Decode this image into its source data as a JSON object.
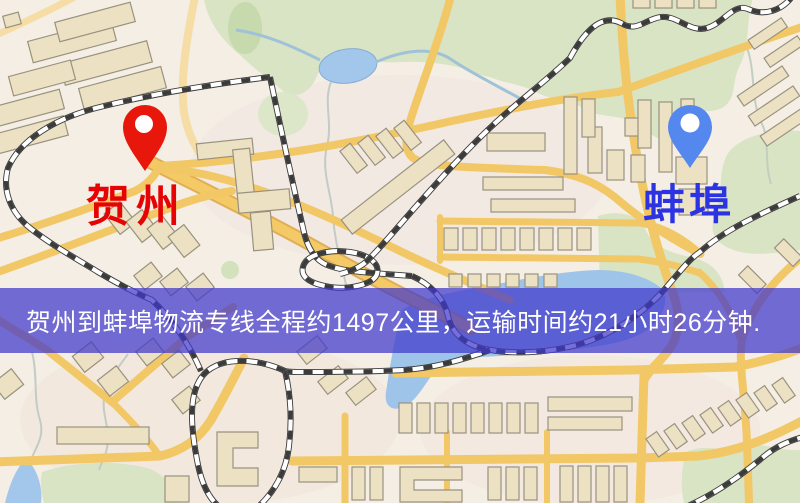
{
  "banner": {
    "text": "贺州到蚌埠物流专线全程约1497公里，运输时间约21小时26分钟.",
    "background_color": "#4038cc",
    "background_opacity": 0.72,
    "text_color": "#ffffff"
  },
  "markers": {
    "origin": {
      "label": "贺州",
      "label_color": "#e60303",
      "pin_color": "#e8170b"
    },
    "destination": {
      "label": "蚌埠",
      "label_color": "#2b33e3",
      "pin_color": "#5588ee"
    }
  },
  "map_colors": {
    "background": "#f4eee4",
    "road": "#f2c766",
    "road_light": "#f5dda5",
    "water": "#9fc4e9",
    "park": "#d8e4c3",
    "building": "#ece1c3",
    "railway": "#3b3b3b"
  }
}
